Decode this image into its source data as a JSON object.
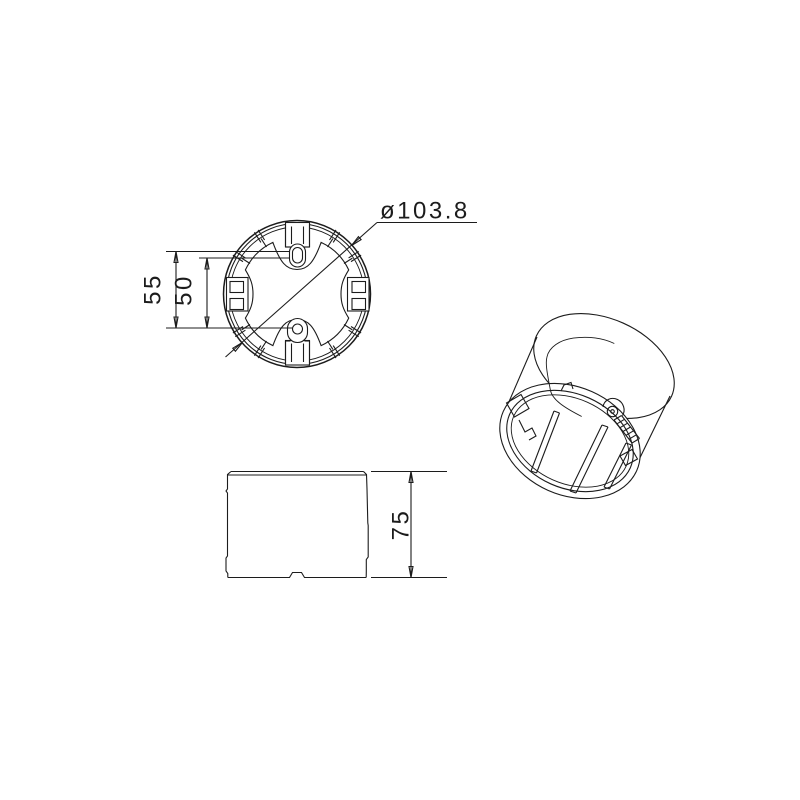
{
  "colors": {
    "background": "#ffffff",
    "line": "#1c1c1c"
  },
  "top_view": {
    "diameter_label": "ø103.8",
    "vertical_dim_outer": "55",
    "vertical_dim_inner": "50"
  },
  "front_view": {
    "height_dim": "75"
  }
}
